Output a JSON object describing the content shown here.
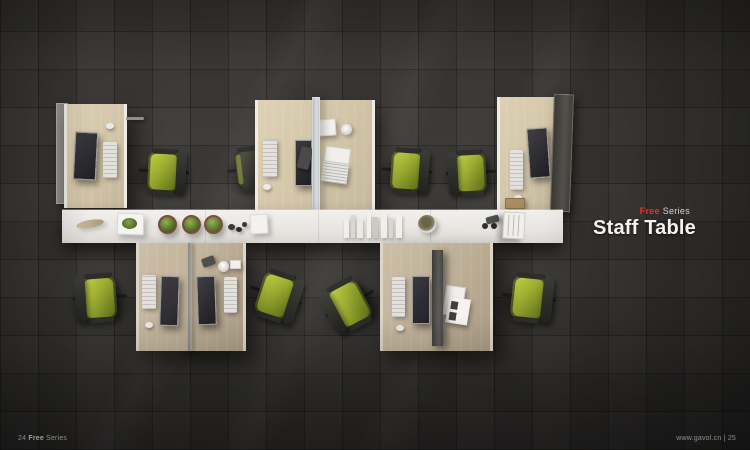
{
  "page": {
    "series_highlight": "Free",
    "series_word": "Series",
    "title": "Staff Table"
  },
  "footer": {
    "left_page": "24",
    "left_series_bold": "Free",
    "left_series_rest": "Series",
    "right_url": "www.gavol.cn",
    "right_separator": "|",
    "right_page": "25"
  },
  "colors": {
    "accent_red": "#e63322",
    "title_text": "#f4f3f1",
    "floor_dark": "#343230",
    "shelf_white": "#edebe7",
    "desk_wood_upper": "#d3c5a8",
    "desk_wood_lower": "#bdae96",
    "chair_green": "#9aab30",
    "chair_frame": "#2d2d29"
  },
  "scene": {
    "description": "Top-down render of Free Series staff workstations: four upper desks with screens, monitors and keyboards, a long white storage credenza decorated with a feather, planter tray, three round plants, pebbles, paper stacks, standing books, a bowl, glasses and a file organizer; four lower back-to-back desks with monitors and documents; seven green task chairs and two dark task chairs on dark tiled flooring."
  }
}
